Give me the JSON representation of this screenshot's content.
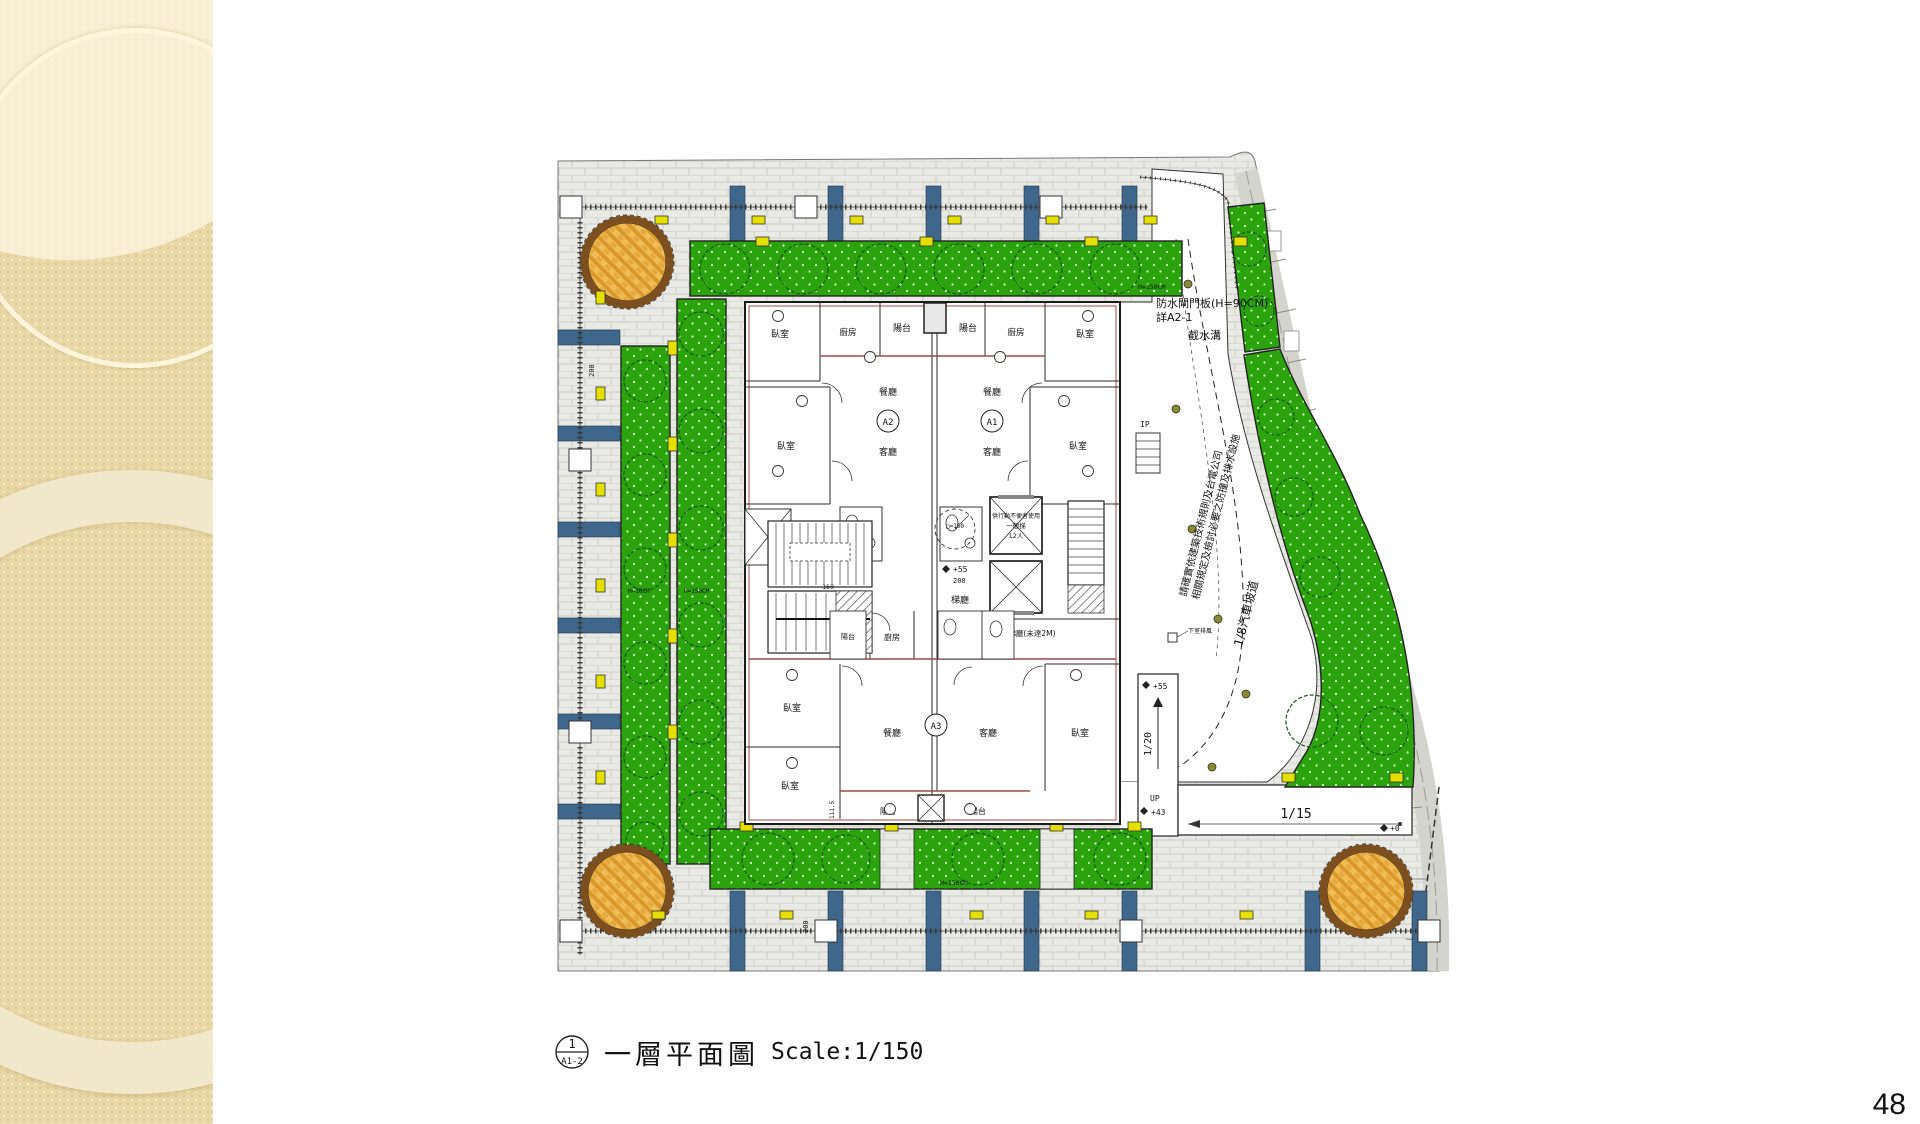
{
  "slide": {
    "page_number": "48"
  },
  "caption": {
    "detail_no": "1",
    "sheet_ref": "A1-2",
    "title": "一層平面圖",
    "scale": "Scale:1/150"
  },
  "plan": {
    "rooms": {
      "bedroom": "臥室",
      "kitchen": "廚房",
      "balcony": "陽台",
      "dining": "餐廳",
      "living": "客廳",
      "lobby": "梯廳",
      "lobby_low": "梯廳(未達2M)",
      "lift_note": "供行動不便者使用",
      "lift_general": "一般梯",
      "lift_cap": "12人"
    },
    "units": {
      "a1": "A1",
      "a2": "A2",
      "a3": "A3"
    },
    "annotations": {
      "flood_gate_line1": "防水閘門板(H=90CM)",
      "flood_gate_line2": "詳A2-1",
      "gutter": "截水溝",
      "note_line1": "請確實依建築技術規則及台電公司",
      "note_line2": "相關規定及檢討必要之防撞及排水設施",
      "car_ramp": "1/8汽車坡道",
      "ramp_20": "1/20",
      "ramp_15": "1/15",
      "up": "UP",
      "ip": "IP",
      "lv55": "+55",
      "lv43": "+43",
      "lv0": "+0",
      "exhaust": "下室排風",
      "hedge150": "H=150CM",
      "hedge10": "H=10CM"
    },
    "dims": {
      "d200": "200",
      "d160": "160",
      "d111": "111.5",
      "d150": "□=150"
    }
  },
  "colors": {
    "planting_green": "#2aa30c",
    "paving_circle_orange": "#e8a93c",
    "band_blue": "#3f678c",
    "light_yellow": "#e6e000",
    "accent_wall_red": "#a34848"
  }
}
